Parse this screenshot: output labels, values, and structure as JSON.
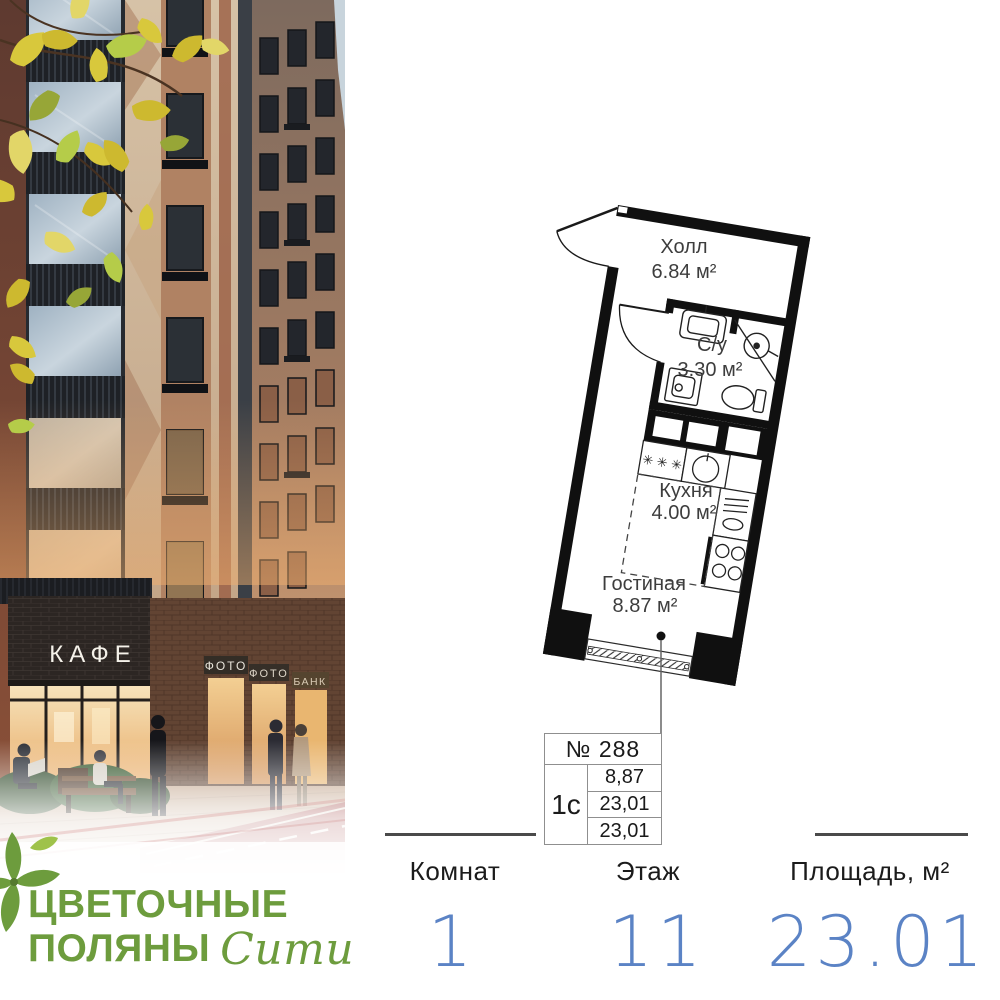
{
  "photo": {
    "signs": {
      "cafe": "КАФЕ",
      "photo_1": "ФОТО",
      "photo_2": "ФОТО",
      "bank": "БАНК"
    }
  },
  "logo": {
    "line1": "ЦВЕТОЧНЫЕ",
    "line2": "ПОЛЯНЫ",
    "script": "Сити",
    "green": "#6d9c3d"
  },
  "plan": {
    "rooms": {
      "hall": {
        "name": "Холл",
        "area": "6.84 м²"
      },
      "bathroom": {
        "name": "С/у",
        "area": "3.30 м²"
      },
      "kitchen": {
        "name": "Кухня",
        "area": "4.00 м²"
      },
      "living": {
        "name": "Гостиная",
        "area": "8.87 м²"
      }
    }
  },
  "info_table": {
    "number": "№ 288",
    "layout_type": "1с",
    "areas": [
      "8,87",
      "23,01",
      "23,01"
    ]
  },
  "summary": {
    "rooms": {
      "label": "Комнат",
      "value": "1"
    },
    "floor": {
      "label": "Этаж",
      "value": "11"
    },
    "area": {
      "label": "Площадь, м²",
      "value": "23.01"
    },
    "accent_blue": "#5b83c5"
  }
}
